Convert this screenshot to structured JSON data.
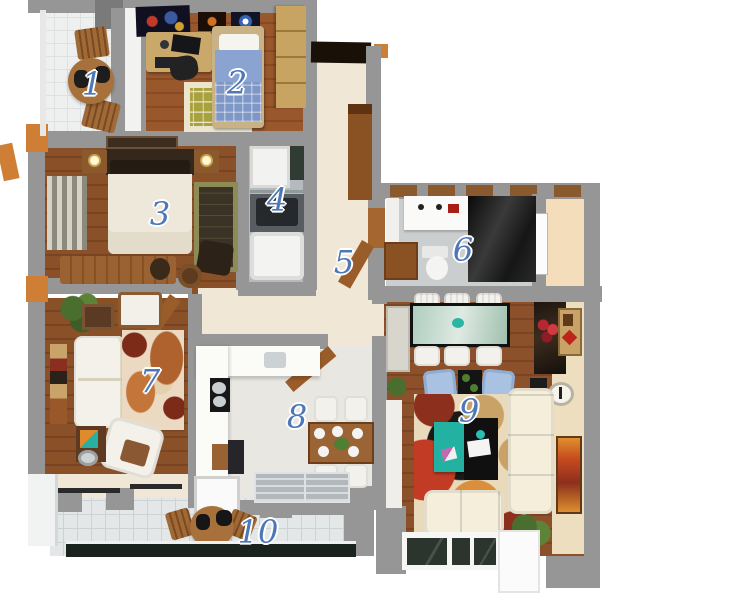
{
  "title": "3D apartment floor plan",
  "rooms": [
    {
      "label": "1",
      "name": "small-balcony"
    },
    {
      "label": "2",
      "name": "kids-bedroom"
    },
    {
      "label": "3",
      "name": "master-bedroom"
    },
    {
      "label": "4",
      "name": "bathroom"
    },
    {
      "label": "5",
      "name": "hallway"
    },
    {
      "label": "6",
      "name": "shower-room"
    },
    {
      "label": "7",
      "name": "lounge"
    },
    {
      "label": "8",
      "name": "kitchen-dining"
    },
    {
      "label": "9",
      "name": "living-room"
    },
    {
      "label": "10",
      "name": "terrace"
    }
  ],
  "colors": {
    "wall_gray": "#969696",
    "wood_brown": "#8a5128",
    "hall_beige": "#f0e7d6",
    "tile_gray": "#e4e7e7",
    "label_blue": "#4d77b6",
    "accent_orange": "#cf7f35",
    "sofa_cream": "#f4eeda",
    "armchair_blue": "#a9c2e2",
    "table_teal": "#23b2a2"
  }
}
